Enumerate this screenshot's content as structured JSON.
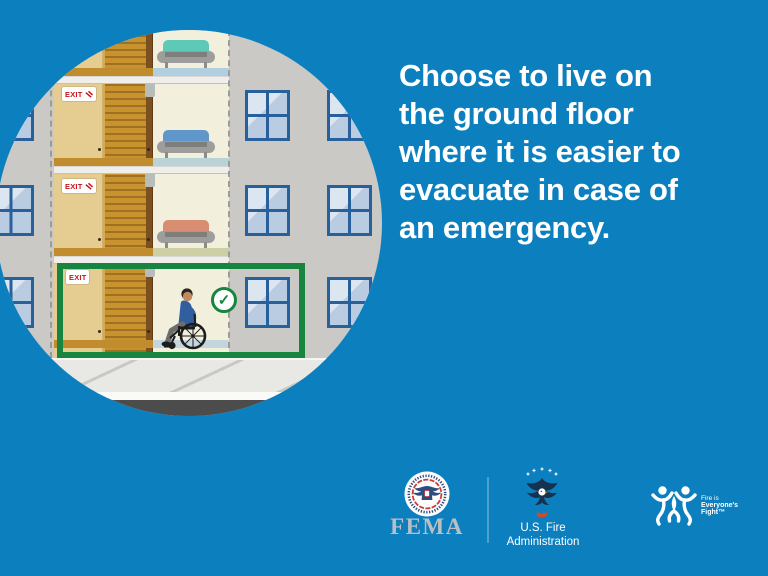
{
  "headline": "Choose to live on\nthe ground floor\nwhere it is easier to\nevacuate in case of\nan emergency.",
  "illustration": {
    "exit_label": "EXIT",
    "checkmark_glyph": "✓"
  },
  "footer": {
    "fema_label": "FEMA",
    "usfa_name_line1": "U.S. Fire",
    "usfa_name_line2": "Administration",
    "fief_line1": "Fire is",
    "fief_line2": "Everyone's",
    "fief_line3": "Fight™"
  },
  "colors": {
    "background_blue": "#0c80bf",
    "headline_white": "#ffffff",
    "highlight_green": "#17853f",
    "exit_red": "#c3161c",
    "facade_gray": "#cac9c6",
    "stairwell_tan": "#e5cd92",
    "stairs_brown": "#c8922f",
    "room_cream": "#f2f0dd",
    "window_pane_blue": "#b9cce1",
    "window_frame_blue": "#27609b",
    "fema_text_gray": "#b9bfc5",
    "usfa_navy": "#16324f"
  }
}
